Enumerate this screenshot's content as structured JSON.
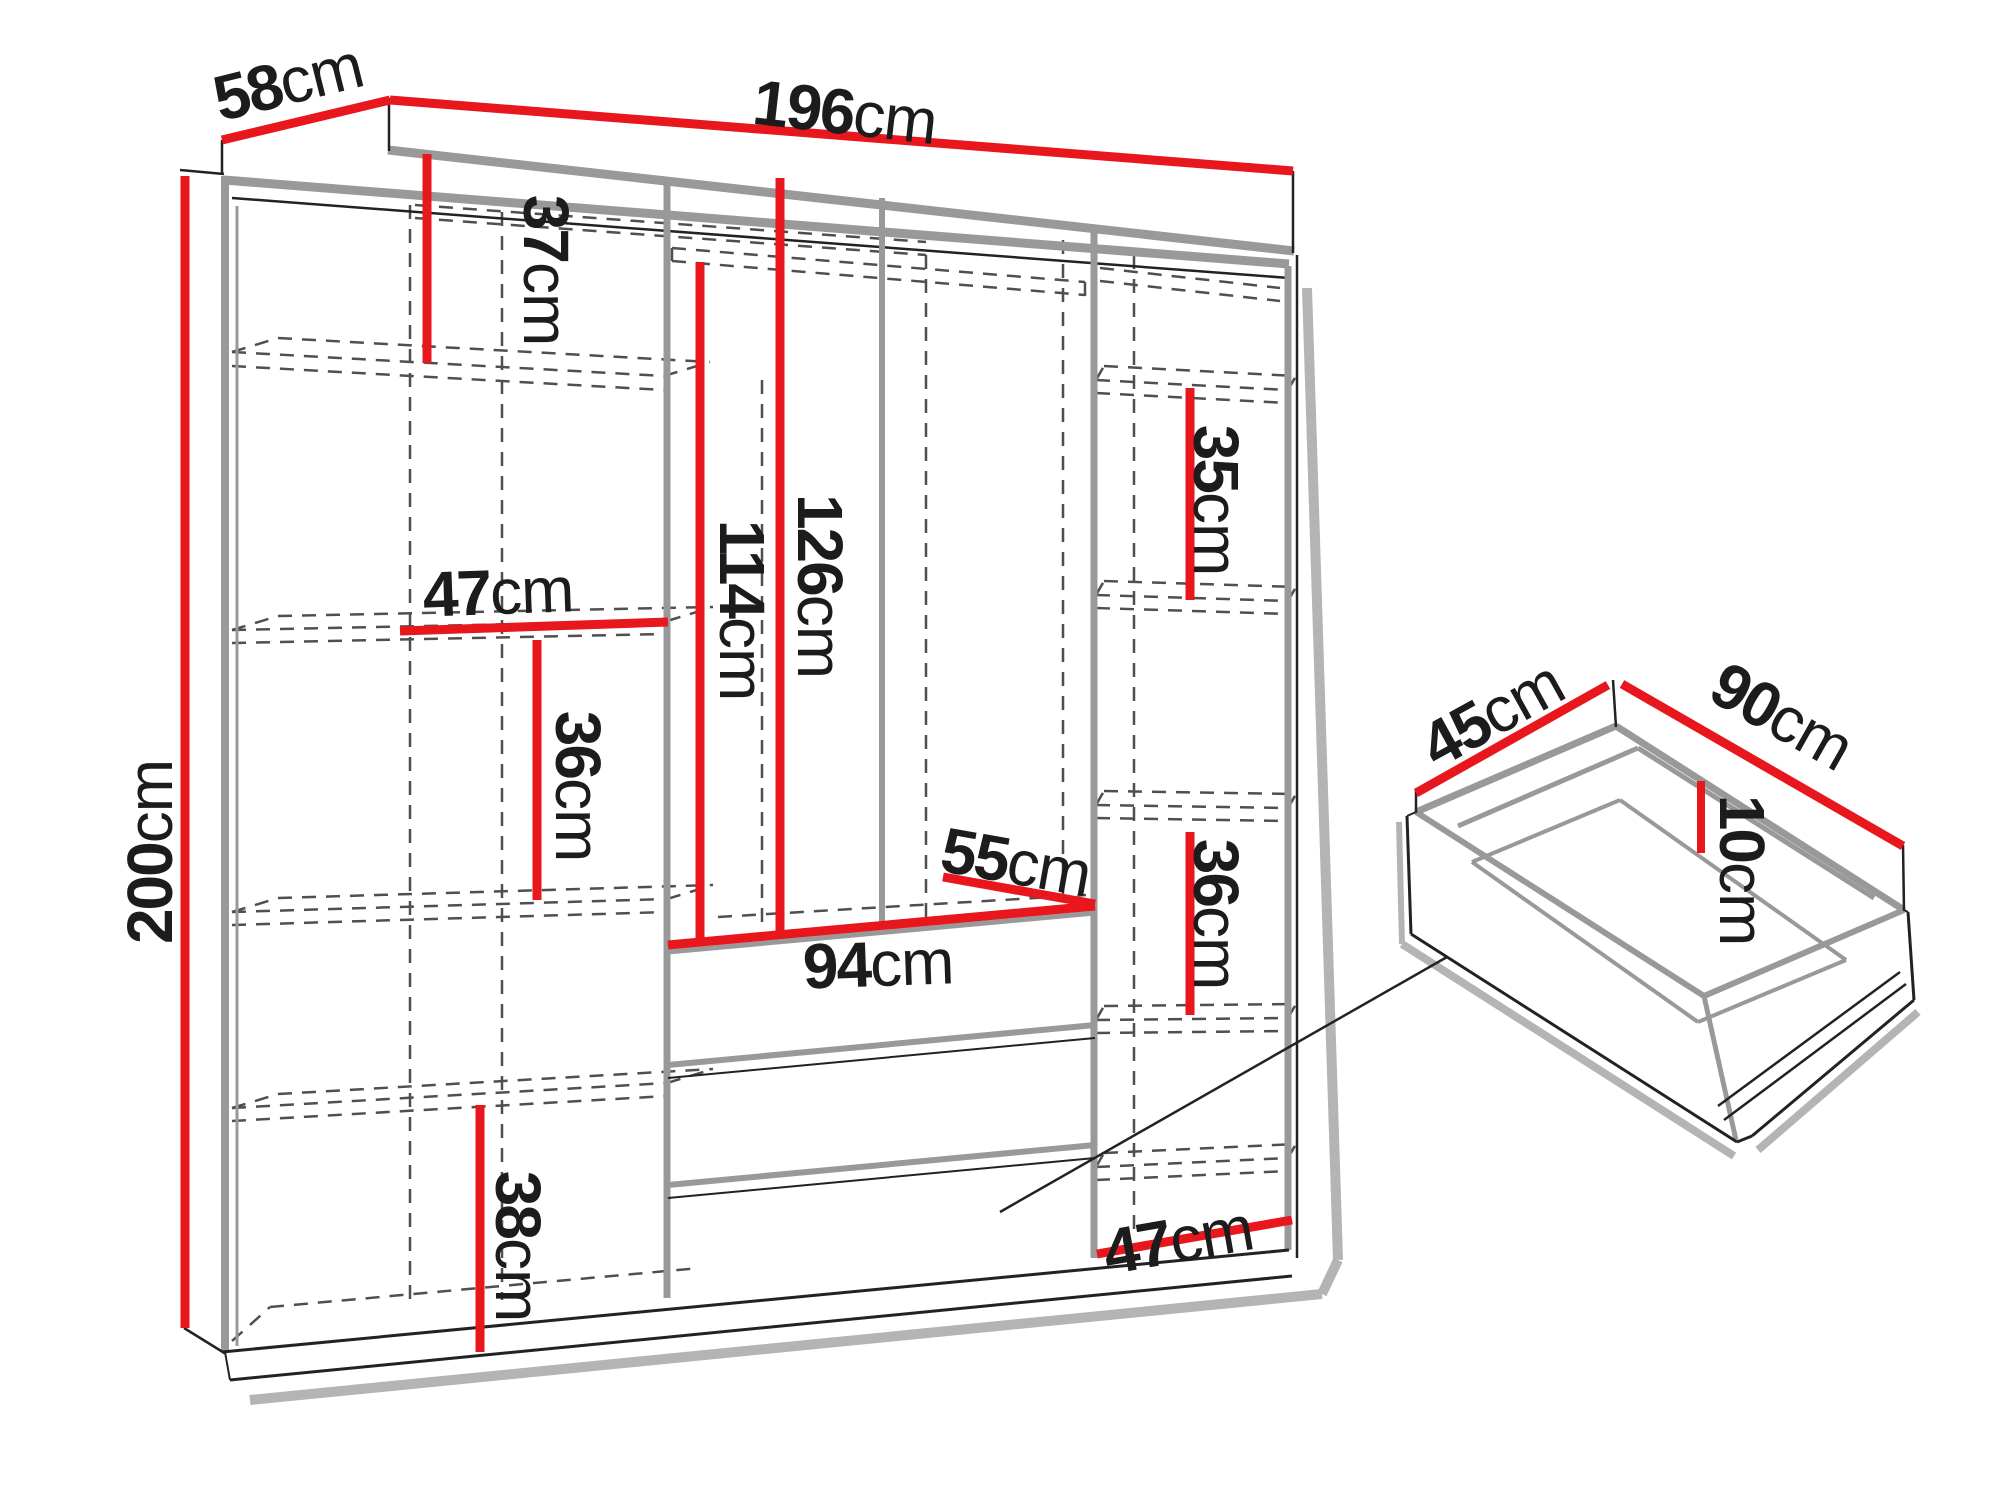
{
  "figure": {
    "type": "furniture-dimension-diagram",
    "subject": "wardrobe with interior shelving, hanging sections, drawers and a detail view of one drawer",
    "background": "#ffffff"
  },
  "colors": {
    "dimension_red": "#e8161d",
    "structure_gray": "#999999",
    "dashed_gray": "#4f4f4f",
    "line_black": "#222222",
    "shadow_gray": "#b4b4b4"
  },
  "measurements": {
    "wardrobe_overall": [
      {
        "part": "width",
        "value": "196cm"
      },
      {
        "part": "depth",
        "value": "58cm"
      },
      {
        "part": "height",
        "value": "200cm"
      }
    ],
    "interior_left_column": [
      "37cm",
      "47cm",
      "36cm",
      "38cm"
    ],
    "interior_middle_section": [
      "126cm",
      "114cm",
      "55cm",
      "94cm"
    ],
    "interior_right_column": [
      "35cm",
      "36cm",
      "47cm"
    ],
    "drawer_detail": [
      {
        "part": "width",
        "value": "90cm"
      },
      {
        "part": "depth",
        "value": "45cm"
      },
      {
        "part": "height",
        "value": "10cm"
      }
    ]
  },
  "labels": [
    {
      "id": "width-196cm",
      "num": "196",
      "unit": "cm",
      "x": 845,
      "y": 112,
      "rot": 6.5,
      "measures": "wardrobe width"
    },
    {
      "id": "depth-58cm",
      "num": "58",
      "unit": "cm",
      "x": 288,
      "y": 82,
      "rot": -14,
      "measures": "wardrobe depth"
    },
    {
      "id": "height-200cm",
      "num": "200",
      "unit": "cm",
      "x": 150,
      "y": 852,
      "rot": -90,
      "measures": "wardrobe height"
    },
    {
      "id": "left-37cm",
      "num": "37",
      "unit": "cm",
      "x": 546,
      "y": 270,
      "rot": 90,
      "measures": "left top compartment height"
    },
    {
      "id": "left-47cm",
      "num": "47",
      "unit": "cm",
      "x": 498,
      "y": 592,
      "rot": -2,
      "measures": "left column width"
    },
    {
      "id": "left-36cm",
      "num": "36",
      "unit": "cm",
      "x": 578,
      "y": 786,
      "rot": 90,
      "measures": "left middle compartment height"
    },
    {
      "id": "left-38cm",
      "num": "38",
      "unit": "cm",
      "x": 518,
      "y": 1246,
      "rot": 90,
      "measures": "left bottom compartment height"
    },
    {
      "id": "mid-114cm",
      "num": "114",
      "unit": "cm",
      "x": 742,
      "y": 610,
      "rot": 90,
      "measures": "hanging space height under shelf"
    },
    {
      "id": "mid-126cm",
      "num": "126",
      "unit": "cm",
      "x": 820,
      "y": 586,
      "rot": 90,
      "measures": "hanging space height"
    },
    {
      "id": "mid-55cm",
      "num": "55",
      "unit": "cm",
      "x": 1016,
      "y": 862,
      "rot": 10,
      "measures": "interior depth"
    },
    {
      "id": "mid-94cm",
      "num": "94",
      "unit": "cm",
      "x": 878,
      "y": 964,
      "rot": -2,
      "measures": "drawer section width"
    },
    {
      "id": "right-35cm",
      "num": "35",
      "unit": "cm",
      "x": 1216,
      "y": 500,
      "rot": 90,
      "measures": "right compartment height"
    },
    {
      "id": "right-36cm",
      "num": "36",
      "unit": "cm",
      "x": 1216,
      "y": 914,
      "rot": 90,
      "measures": "right lower compartment height"
    },
    {
      "id": "right-47cm",
      "num": "47",
      "unit": "cm",
      "x": 1178,
      "y": 1240,
      "rot": -10,
      "measures": "right column width"
    },
    {
      "id": "drawer-45cm",
      "num": "45",
      "unit": "cm",
      "x": 1492,
      "y": 714,
      "rot": -29,
      "measures": "drawer depth"
    },
    {
      "id": "drawer-90cm",
      "num": "90",
      "unit": "cm",
      "x": 1782,
      "y": 716,
      "rot": 29.5,
      "measures": "drawer width"
    },
    {
      "id": "drawer-10cm",
      "num": "10",
      "unit": "cm",
      "x": 1742,
      "y": 870,
      "rot": 90,
      "measures": "drawer height"
    }
  ]
}
